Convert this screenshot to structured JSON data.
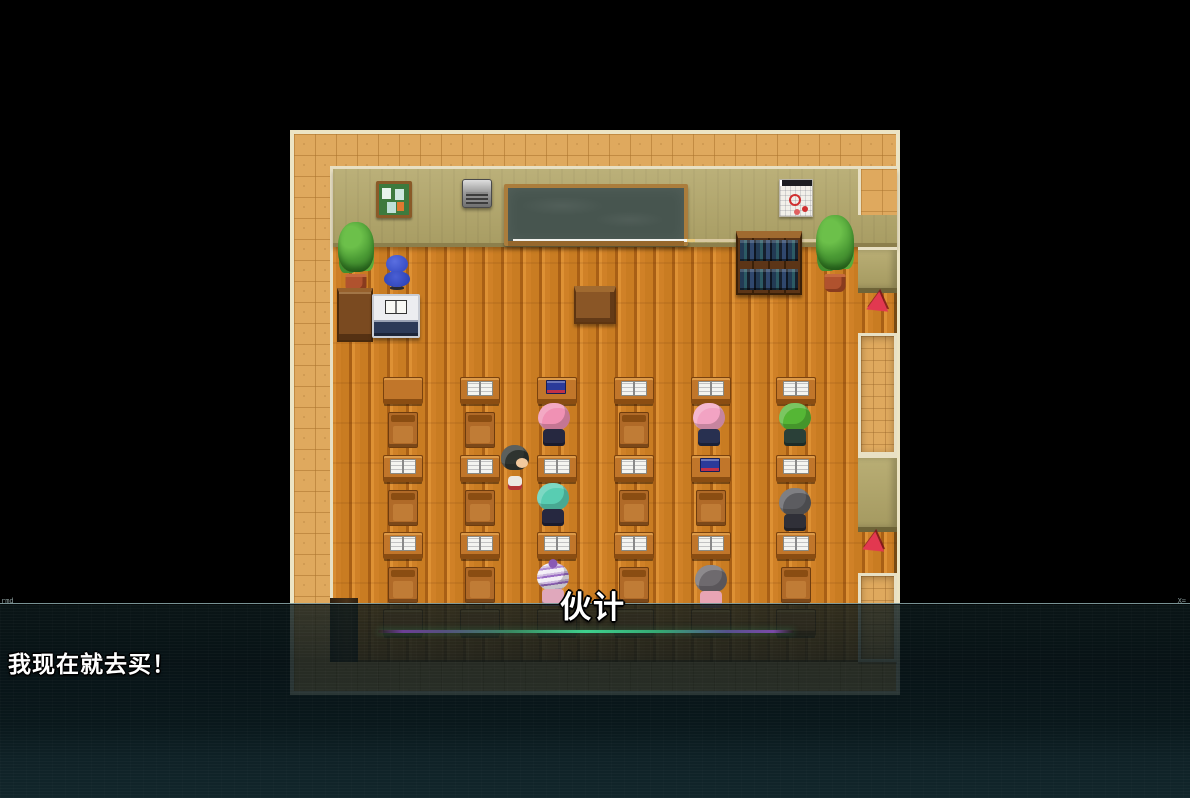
{
  "dialogue": {
    "speaker": "伙计",
    "text": "我现在就去买！"
  },
  "hud": {
    "watermark_left": "rmd",
    "watermark_right": "X="
  },
  "palette": {
    "background": "#000000",
    "border_tiles": "#dfa95e",
    "border_trim": "#ece4c4",
    "wall": "#b3a76a",
    "floor_wood": "#d08127",
    "blackboard": "#47554f",
    "overlay_teal": "#0e2024",
    "aura_purple": "#7a4aa8",
    "aura_green": "#3ed28e",
    "cone_red": "#e23850",
    "dialogue_text": "#ffffff"
  },
  "scene": {
    "map": {
      "x": 290,
      "y": 130,
      "w": 610,
      "h": 565
    },
    "room": {
      "x": 330,
      "y": 166,
      "w": 567,
      "h": 496
    },
    "wall": {
      "x": 333,
      "y": 169,
      "w": 564,
      "h": 78
    },
    "wall_corner": {
      "x": 858,
      "y": 169,
      "w": 39,
      "h": 46
    },
    "furniture": [
      {
        "kind": "corkboard",
        "name": "notice-board",
        "x": 376,
        "y": 181,
        "w": 36,
        "h": 37
      },
      {
        "kind": "ac-unit",
        "name": "wall-speaker",
        "x": 462,
        "y": 179,
        "w": 30,
        "h": 29
      },
      {
        "kind": "blackboard",
        "name": "blackboard",
        "x": 504,
        "y": 184,
        "w": 184,
        "h": 62
      },
      {
        "kind": "calendar",
        "name": "wall-calendar",
        "x": 779,
        "y": 179,
        "w": 34,
        "h": 38
      },
      {
        "kind": "bookshelf",
        "name": "bookshelf",
        "x": 736,
        "y": 231,
        "w": 66,
        "h": 64
      },
      {
        "kind": "plant",
        "name": "potted-plant-left",
        "x": 338,
        "y": 222,
        "w": 36,
        "h": 70
      },
      {
        "kind": "plant",
        "name": "potted-plant-right",
        "x": 816,
        "y": 215,
        "w": 38,
        "h": 77
      },
      {
        "kind": "blue-chair",
        "name": "teacher-chair",
        "x": 380,
        "y": 254,
        "w": 34,
        "h": 48
      },
      {
        "kind": "cabinet",
        "name": "side-cabinet",
        "x": 337,
        "y": 288,
        "w": 36,
        "h": 54
      },
      {
        "kind": "teacher-desk",
        "name": "teacher-desk",
        "x": 372,
        "y": 294,
        "w": 48,
        "h": 44
      },
      {
        "kind": "podium",
        "name": "lectern",
        "x": 574,
        "y": 286,
        "w": 42,
        "h": 38
      },
      {
        "kind": "door-shadow",
        "name": "doorway-shadow",
        "x": 330,
        "y": 598,
        "w": 28,
        "h": 64
      },
      {
        "kind": "pillar",
        "name": "right-pillar-top",
        "x": 858,
        "y": 247,
        "w": 39,
        "h": 46
      },
      {
        "kind": "alcove",
        "name": "right-alcove-top",
        "x": 858,
        "y": 333,
        "w": 39,
        "h": 122
      },
      {
        "kind": "pillar",
        "name": "right-pillar-mid",
        "x": 858,
        "y": 455,
        "w": 39,
        "h": 77
      },
      {
        "kind": "alcove",
        "name": "right-alcove-bottom",
        "x": 858,
        "y": 573,
        "w": 39,
        "h": 89
      },
      {
        "kind": "cone",
        "name": "red-marker-top",
        "x": 862,
        "y": 294,
        "w": 26,
        "h": 24
      },
      {
        "kind": "cone",
        "name": "red-marker-bottom",
        "x": 858,
        "y": 534,
        "w": 28,
        "h": 26
      }
    ],
    "desks": {
      "cols": [
        383,
        460,
        537,
        614,
        691,
        776
      ],
      "desk_rows": [
        377,
        455,
        532,
        609
      ],
      "desk_w": 40,
      "desk_h": 27,
      "books": [
        [
          "none",
          "open",
          "blue",
          "open",
          "open",
          "open"
        ],
        [
          "open",
          "open",
          "open",
          "open",
          "blue",
          "open"
        ],
        [
          "open",
          "open",
          "open",
          "open",
          "open",
          "open"
        ],
        [
          "none",
          "none",
          "none",
          "none",
          "none",
          "none"
        ]
      ],
      "chair_rows": [
        412,
        490,
        567
      ],
      "chair_w": 30,
      "chair_h": 36,
      "chair_skips": [
        [
          2,
          4,
          5
        ],
        [
          2,
          5
        ],
        [
          2,
          4
        ]
      ]
    },
    "characters": [
      {
        "name": "player",
        "type": "standing",
        "x": 500,
        "y": 445,
        "hair": "#2f3430",
        "body": "#ece8e2"
      },
      {
        "name": "student-pink-short",
        "type": "sitting",
        "x": 537,
        "y": 403,
        "hair": "#f091b4",
        "body": "#262840"
      },
      {
        "name": "student-teal",
        "type": "sitting",
        "x": 536,
        "y": 483,
        "hair": "#58cdb2",
        "body": "#262840"
      },
      {
        "name": "student-white-hat",
        "type": "hat",
        "x": 536,
        "y": 563,
        "hair": "#f2eef6",
        "body": "#e0a8bc"
      },
      {
        "name": "student-pink-long",
        "type": "sitting",
        "x": 692,
        "y": 403,
        "hair": "#f2a3c3",
        "body": "#283050"
      },
      {
        "name": "student-green",
        "type": "sitting",
        "x": 778,
        "y": 403,
        "hair": "#55b635",
        "body": "#2a4038"
      },
      {
        "name": "student-dark",
        "type": "sitting",
        "x": 778,
        "y": 488,
        "hair": "#5c5c60",
        "body": "#303038"
      },
      {
        "name": "student-gray-bob",
        "type": "sitting",
        "x": 694,
        "y": 565,
        "hair": "#6e6a6e",
        "body": "#e8a4b4"
      }
    ],
    "effects": {
      "aura_line": {
        "x": 378,
        "y": 630,
        "w": 416,
        "h": 3
      }
    },
    "overlay": {
      "x": 0,
      "y": 603,
      "w": 1190,
      "h": 195
    },
    "name_label": {
      "x": 560,
      "y": 582,
      "font_px": 31
    },
    "message": {
      "x": 8,
      "y": 645,
      "font_px": 23
    }
  }
}
